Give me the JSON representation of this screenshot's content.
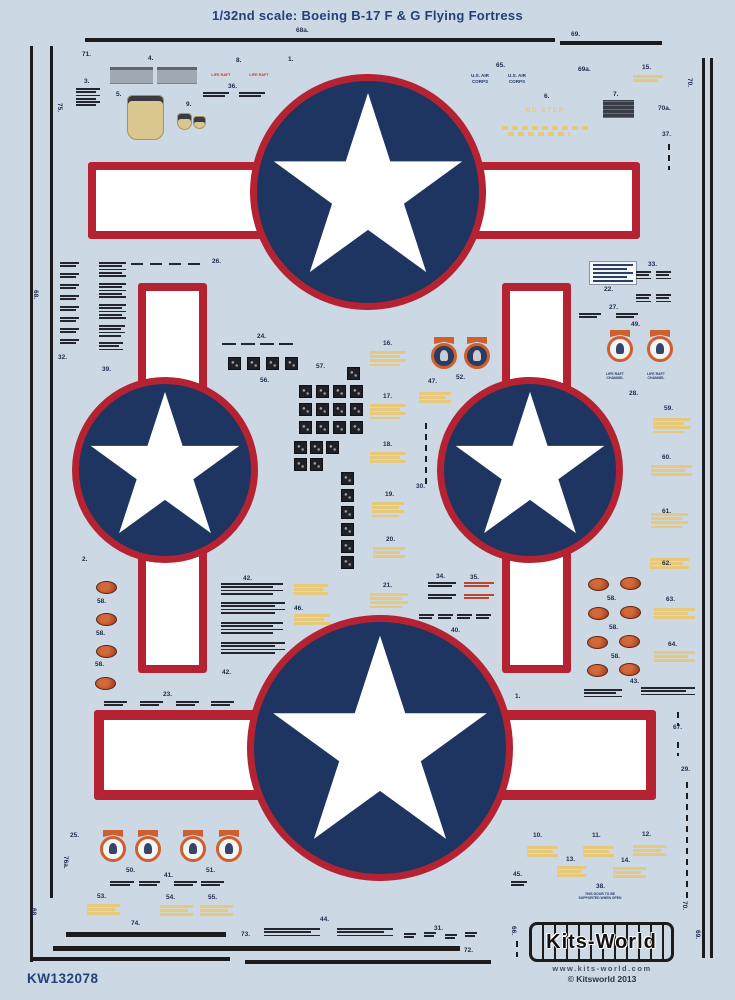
{
  "title": "1/32nd scale: Boeing B-17 F & G Flying Fortress",
  "sheet_code": "KW132078",
  "brand": {
    "logo": "Kits-World",
    "url": "www.kits-world.com",
    "copyright": "© Kitsworld 2013"
  },
  "colors": {
    "bg": "#ccd8e4",
    "navy": "#1d3560",
    "red": "#b52231",
    "star": "#ffffff",
    "yellow": "#e6c97c",
    "orange": "#cf5f2e",
    "label": "#1e2a4a",
    "dark": "#23262e",
    "gray": "#a0a8b2",
    "tan": "#d9c78f",
    "brand_navy": "#23407a",
    "stencil_red": "#c0432b"
  },
  "insignia": [
    {
      "cx": 368,
      "cy": 192,
      "r": 118,
      "star_r": 104,
      "bar": {
        "x": 88,
        "y": 162,
        "w": 552,
        "h": 77,
        "bw": 8
      }
    },
    {
      "cx": 165,
      "cy": 470,
      "r": 93,
      "star_r": 82,
      "bar": {
        "x": 138,
        "y": 283,
        "w": 69,
        "h": 390,
        "bw": 8
      }
    },
    {
      "cx": 530,
      "cy": 470,
      "r": 93,
      "star_r": 82,
      "bar": {
        "x": 502,
        "y": 283,
        "w": 69,
        "h": 390,
        "bw": 8
      }
    },
    {
      "cx": 380,
      "cy": 748,
      "r": 133,
      "star_r": 118,
      "bar": {
        "x": 94,
        "y": 710,
        "w": 562,
        "h": 90,
        "bw": 10
      }
    }
  ],
  "labels": [
    {
      "t": "71.",
      "x": 82,
      "y": 52
    },
    {
      "t": "3.",
      "x": 84,
      "y": 79
    },
    {
      "t": "4.",
      "x": 148,
      "y": 56
    },
    {
      "t": "8.",
      "x": 236,
      "y": 58
    },
    {
      "t": "36.",
      "x": 228,
      "y": 84
    },
    {
      "t": "1.",
      "x": 288,
      "y": 57
    },
    {
      "t": "5.",
      "x": 116,
      "y": 92
    },
    {
      "t": "9.",
      "x": 186,
      "y": 102
    },
    {
      "t": "65.",
      "x": 496,
      "y": 63
    },
    {
      "t": "69a.",
      "x": 578,
      "y": 67
    },
    {
      "t": "15.",
      "x": 642,
      "y": 65
    },
    {
      "t": "6.",
      "x": 544,
      "y": 94
    },
    {
      "t": "7.",
      "x": 613,
      "y": 92
    },
    {
      "t": "68a.",
      "x": 296,
      "y": 28
    },
    {
      "t": "69.",
      "x": 571,
      "y": 32
    },
    {
      "t": "70.",
      "x": 692,
      "y": 78,
      "r": 1
    },
    {
      "t": "70a.",
      "x": 658,
      "y": 106
    },
    {
      "t": "37.",
      "x": 662,
      "y": 132
    },
    {
      "t": "75.",
      "x": 62,
      "y": 103,
      "r": 1
    },
    {
      "t": "68.",
      "x": 38,
      "y": 290,
      "r": 1
    },
    {
      "t": "26.",
      "x": 212,
      "y": 259
    },
    {
      "t": "32.",
      "x": 58,
      "y": 355
    },
    {
      "t": "39.",
      "x": 102,
      "y": 367
    },
    {
      "t": "24.",
      "x": 257,
      "y": 334
    },
    {
      "t": "56.",
      "x": 260,
      "y": 378
    },
    {
      "t": "57.",
      "x": 316,
      "y": 364
    },
    {
      "t": "16.",
      "x": 383,
      "y": 341
    },
    {
      "t": "47.",
      "x": 428,
      "y": 379
    },
    {
      "t": "52.",
      "x": 456,
      "y": 375
    },
    {
      "t": "17.",
      "x": 383,
      "y": 394
    },
    {
      "t": "18.",
      "x": 383,
      "y": 442
    },
    {
      "t": "30.",
      "x": 416,
      "y": 484
    },
    {
      "t": "19.",
      "x": 385,
      "y": 492
    },
    {
      "t": "20.",
      "x": 386,
      "y": 537
    },
    {
      "t": "21.",
      "x": 383,
      "y": 583
    },
    {
      "t": "33.",
      "x": 648,
      "y": 262
    },
    {
      "t": "22.",
      "x": 604,
      "y": 287
    },
    {
      "t": "27.",
      "x": 609,
      "y": 305
    },
    {
      "t": "49.",
      "x": 631,
      "y": 322
    },
    {
      "t": "28.",
      "x": 629,
      "y": 391
    },
    {
      "t": "59.",
      "x": 664,
      "y": 406
    },
    {
      "t": "60.",
      "x": 662,
      "y": 455
    },
    {
      "t": "61.",
      "x": 662,
      "y": 509
    },
    {
      "t": "62.",
      "x": 662,
      "y": 561
    },
    {
      "t": "63.",
      "x": 666,
      "y": 597
    },
    {
      "t": "64.",
      "x": 668,
      "y": 642
    },
    {
      "t": "2.",
      "x": 82,
      "y": 557
    },
    {
      "t": "58.",
      "x": 97,
      "y": 599
    },
    {
      "t": "58.",
      "x": 96,
      "y": 631
    },
    {
      "t": "58.",
      "x": 95,
      "y": 662
    },
    {
      "t": "42.",
      "x": 243,
      "y": 576
    },
    {
      "t": "46.",
      "x": 294,
      "y": 606
    },
    {
      "t": "42.",
      "x": 222,
      "y": 670
    },
    {
      "t": "58.",
      "x": 607,
      "y": 596
    },
    {
      "t": "58.",
      "x": 609,
      "y": 625
    },
    {
      "t": "58.",
      "x": 611,
      "y": 654
    },
    {
      "t": "43.",
      "x": 630,
      "y": 679
    },
    {
      "t": "34.",
      "x": 436,
      "y": 574
    },
    {
      "t": "35.",
      "x": 470,
      "y": 575
    },
    {
      "t": "40.",
      "x": 451,
      "y": 628
    },
    {
      "t": "23.",
      "x": 163,
      "y": 692
    },
    {
      "t": "1.",
      "x": 515,
      "y": 694
    },
    {
      "t": "67.",
      "x": 673,
      "y": 725
    },
    {
      "t": "29.",
      "x": 681,
      "y": 767
    },
    {
      "t": "25.",
      "x": 70,
      "y": 833
    },
    {
      "t": "76a.",
      "x": 68,
      "y": 856,
      "r": 1
    },
    {
      "t": "68.",
      "x": 36,
      "y": 908,
      "r": 1
    },
    {
      "t": "50.",
      "x": 126,
      "y": 868
    },
    {
      "t": "41.",
      "x": 164,
      "y": 873
    },
    {
      "t": "51.",
      "x": 206,
      "y": 868
    },
    {
      "t": "53.",
      "x": 97,
      "y": 894
    },
    {
      "t": "54.",
      "x": 166,
      "y": 895
    },
    {
      "t": "55.",
      "x": 208,
      "y": 895
    },
    {
      "t": "74.",
      "x": 131,
      "y": 921
    },
    {
      "t": "73.",
      "x": 241,
      "y": 932
    },
    {
      "t": "44.",
      "x": 320,
      "y": 917
    },
    {
      "t": "31.",
      "x": 434,
      "y": 926
    },
    {
      "t": "72.",
      "x": 464,
      "y": 948
    },
    {
      "t": "10.",
      "x": 533,
      "y": 833
    },
    {
      "t": "11.",
      "x": 592,
      "y": 833
    },
    {
      "t": "12.",
      "x": 642,
      "y": 832
    },
    {
      "t": "13.",
      "x": 566,
      "y": 857
    },
    {
      "t": "14.",
      "x": 621,
      "y": 858
    },
    {
      "t": "38.",
      "x": 596,
      "y": 884
    },
    {
      "t": "45.",
      "x": 513,
      "y": 872
    },
    {
      "t": "66.",
      "x": 516,
      "y": 926,
      "r": 1
    },
    {
      "t": "70.",
      "x": 687,
      "y": 901,
      "r": 1
    },
    {
      "t": "69.",
      "x": 700,
      "y": 930,
      "r": 1
    }
  ],
  "texts": [
    {
      "lines": [
        "LIFE RAFT"
      ],
      "x": 204,
      "y": 73,
      "fs": 3.8,
      "c": "#c23b2a",
      "w": 34
    },
    {
      "lines": [
        "LIFE RAFT"
      ],
      "x": 242,
      "y": 73,
      "fs": 3.8,
      "c": "#c23b2a",
      "w": 34
    },
    {
      "lines": [
        "U.S. AIR",
        "CORPS"
      ],
      "x": 462,
      "y": 73,
      "fs": 4.6,
      "c": "#233a66",
      "w": 36
    },
    {
      "lines": [
        "U.S. AIR",
        "CORPS"
      ],
      "x": 499,
      "y": 73,
      "fs": 4.6,
      "c": "#233a66",
      "w": 36
    },
    {
      "lines": [
        "NO STEP"
      ],
      "x": 517,
      "y": 107,
      "fs": 6.5,
      "c": "#e6c97c",
      "w": 56,
      "ls": 1.5
    },
    {
      "lines": [
        "LIFE RAFT",
        "CHANNEL"
      ],
      "x": 598,
      "y": 372,
      "fs": 3.5,
      "c": "#233a66",
      "w": 34
    },
    {
      "lines": [
        "LIFE RAFT",
        "CHANNEL"
      ],
      "x": 639,
      "y": 372,
      "fs": 3.5,
      "c": "#233a66",
      "w": 34
    },
    {
      "lines": [
        "THIS DOOR TO BE",
        "SUPPORTED WHEN OPEN"
      ],
      "x": 562,
      "y": 892,
      "fs": 3.4,
      "c": "#233a66",
      "w": 76
    }
  ],
  "micro_blocks": [
    {
      "x": 76,
      "y": 88,
      "w": 24,
      "n": 6
    },
    {
      "x": 60,
      "y": 262,
      "w": 19,
      "n": 2
    },
    {
      "x": 60,
      "y": 273,
      "w": 19,
      "n": 2
    },
    {
      "x": 60,
      "y": 284,
      "w": 19,
      "n": 2
    },
    {
      "x": 60,
      "y": 295,
      "w": 19,
      "n": 2
    },
    {
      "x": 60,
      "y": 306,
      "w": 19,
      "n": 2
    },
    {
      "x": 60,
      "y": 317,
      "w": 19,
      "n": 2
    },
    {
      "x": 60,
      "y": 328,
      "w": 19,
      "n": 2
    },
    {
      "x": 60,
      "y": 339,
      "w": 19,
      "n": 2
    },
    {
      "x": 99,
      "y": 262,
      "w": 27,
      "n": 5
    },
    {
      "x": 99,
      "y": 283,
      "w": 27,
      "n": 5
    },
    {
      "x": 99,
      "y": 304,
      "w": 27,
      "n": 5
    },
    {
      "x": 99,
      "y": 325,
      "w": 26,
      "n": 4
    },
    {
      "x": 99,
      "y": 342,
      "w": 24,
      "n": 3
    },
    {
      "x": 203,
      "y": 92,
      "w": 26,
      "n": 2
    },
    {
      "x": 239,
      "y": 92,
      "w": 26,
      "n": 2
    },
    {
      "x": 636,
      "y": 271,
      "w": 15,
      "n": 3
    },
    {
      "x": 656,
      "y": 271,
      "w": 15,
      "n": 3
    },
    {
      "x": 636,
      "y": 294,
      "w": 15,
      "n": 3
    },
    {
      "x": 656,
      "y": 294,
      "w": 15,
      "n": 3
    },
    {
      "x": 579,
      "y": 313,
      "w": 22,
      "n": 2
    },
    {
      "x": 616,
      "y": 313,
      "w": 22,
      "n": 2
    },
    {
      "x": 222,
      "y": 343,
      "w": 14,
      "n": 1
    },
    {
      "x": 241,
      "y": 343,
      "w": 14,
      "n": 1
    },
    {
      "x": 260,
      "y": 343,
      "w": 14,
      "n": 1
    },
    {
      "x": 279,
      "y": 343,
      "w": 14,
      "n": 1
    },
    {
      "x": 131,
      "y": 263,
      "w": 12,
      "n": 1
    },
    {
      "x": 150,
      "y": 263,
      "w": 12,
      "n": 1
    },
    {
      "x": 169,
      "y": 263,
      "w": 12,
      "n": 1
    },
    {
      "x": 188,
      "y": 263,
      "w": 12,
      "n": 1
    },
    {
      "x": 428,
      "y": 582,
      "w": 28,
      "n": 2
    },
    {
      "x": 428,
      "y": 594,
      "w": 28,
      "n": 2
    },
    {
      "x": 464,
      "y": 582,
      "w": 30,
      "n": 2,
      "c": "r"
    },
    {
      "x": 464,
      "y": 594,
      "w": 30,
      "n": 2,
      "c": "r"
    },
    {
      "x": 419,
      "y": 614,
      "w": 15,
      "n": 2
    },
    {
      "x": 438,
      "y": 614,
      "w": 15,
      "n": 2
    },
    {
      "x": 457,
      "y": 614,
      "w": 15,
      "n": 2
    },
    {
      "x": 476,
      "y": 614,
      "w": 15,
      "n": 2
    },
    {
      "x": 221,
      "y": 583,
      "w": 62,
      "n": 4
    },
    {
      "x": 221,
      "y": 602,
      "w": 64,
      "n": 4
    },
    {
      "x": 221,
      "y": 622,
      "w": 62,
      "n": 4
    },
    {
      "x": 221,
      "y": 642,
      "w": 64,
      "n": 4
    },
    {
      "x": 584,
      "y": 689,
      "w": 38,
      "n": 3
    },
    {
      "x": 641,
      "y": 687,
      "w": 54,
      "n": 3
    },
    {
      "x": 104,
      "y": 701,
      "w": 23,
      "n": 2
    },
    {
      "x": 140,
      "y": 701,
      "w": 23,
      "n": 2
    },
    {
      "x": 176,
      "y": 701,
      "w": 23,
      "n": 2
    },
    {
      "x": 211,
      "y": 701,
      "w": 23,
      "n": 2
    },
    {
      "x": 404,
      "y": 933,
      "w": 12,
      "n": 2
    },
    {
      "x": 424,
      "y": 932,
      "w": 12,
      "n": 2
    },
    {
      "x": 445,
      "y": 934,
      "w": 12,
      "n": 2
    },
    {
      "x": 465,
      "y": 932,
      "w": 12,
      "n": 2
    },
    {
      "x": 264,
      "y": 928,
      "w": 56,
      "n": 3
    },
    {
      "x": 337,
      "y": 928,
      "w": 56,
      "n": 3
    },
    {
      "x": 511,
      "y": 881,
      "w": 16,
      "n": 2
    },
    {
      "x": 110,
      "y": 881,
      "w": 24,
      "n": 2
    },
    {
      "x": 139,
      "y": 881,
      "w": 21,
      "n": 2
    },
    {
      "x": 174,
      "y": 881,
      "w": 23,
      "n": 2
    },
    {
      "x": 201,
      "y": 881,
      "w": 23,
      "n": 2
    },
    {
      "x": 633,
      "y": 75,
      "w": 30,
      "n": 2,
      "c": "y"
    },
    {
      "x": 370,
      "y": 351,
      "w": 36,
      "n": 4,
      "c": "y"
    },
    {
      "x": 370,
      "y": 404,
      "w": 36,
      "n": 4,
      "c": "y"
    },
    {
      "x": 370,
      "y": 452,
      "w": 36,
      "n": 3,
      "c": "y"
    },
    {
      "x": 372,
      "y": 502,
      "w": 32,
      "n": 4,
      "c": "y"
    },
    {
      "x": 373,
      "y": 547,
      "w": 32,
      "n": 3,
      "c": "y"
    },
    {
      "x": 370,
      "y": 593,
      "w": 38,
      "n": 4,
      "c": "y"
    },
    {
      "x": 419,
      "y": 392,
      "w": 32,
      "n": 3,
      "c": "y"
    },
    {
      "x": 294,
      "y": 584,
      "w": 34,
      "n": 3,
      "c": "y"
    },
    {
      "x": 294,
      "y": 614,
      "w": 36,
      "n": 3,
      "c": "y"
    },
    {
      "x": 653,
      "y": 418,
      "w": 37,
      "n": 4,
      "c": "y"
    },
    {
      "x": 651,
      "y": 465,
      "w": 41,
      "n": 3,
      "c": "y"
    },
    {
      "x": 651,
      "y": 513,
      "w": 37,
      "n": 4,
      "c": "y"
    },
    {
      "x": 650,
      "y": 558,
      "w": 39,
      "n": 3,
      "c": "y"
    },
    {
      "x": 654,
      "y": 608,
      "w": 41,
      "n": 3,
      "c": "y"
    },
    {
      "x": 654,
      "y": 651,
      "w": 41,
      "n": 3,
      "c": "y"
    },
    {
      "x": 87,
      "y": 904,
      "w": 33,
      "n": 3,
      "c": "y"
    },
    {
      "x": 160,
      "y": 905,
      "w": 33,
      "n": 3,
      "c": "y"
    },
    {
      "x": 200,
      "y": 905,
      "w": 33,
      "n": 3,
      "c": "y"
    },
    {
      "x": 527,
      "y": 846,
      "w": 31,
      "n": 3,
      "c": "y"
    },
    {
      "x": 583,
      "y": 846,
      "w": 31,
      "n": 3,
      "c": "y"
    },
    {
      "x": 633,
      "y": 845,
      "w": 33,
      "n": 3,
      "c": "y"
    },
    {
      "x": 557,
      "y": 866,
      "w": 29,
      "n": 3,
      "c": "y"
    },
    {
      "x": 613,
      "y": 867,
      "w": 33,
      "n": 3,
      "c": "y"
    }
  ],
  "black_squares": [
    [
      228,
      357
    ],
    [
      247,
      357
    ],
    [
      266,
      357
    ],
    [
      285,
      357
    ],
    [
      347,
      367
    ],
    [
      299,
      385
    ],
    [
      316,
      385
    ],
    [
      333,
      385
    ],
    [
      350,
      385
    ],
    [
      299,
      403
    ],
    [
      316,
      403
    ],
    [
      333,
      403
    ],
    [
      350,
      403
    ],
    [
      299,
      421
    ],
    [
      316,
      421
    ],
    [
      333,
      421
    ],
    [
      350,
      421
    ],
    [
      294,
      441
    ],
    [
      310,
      441
    ],
    [
      326,
      441
    ],
    [
      294,
      458
    ],
    [
      310,
      458
    ],
    [
      341,
      472
    ],
    [
      341,
      489
    ],
    [
      341,
      506
    ],
    [
      341,
      523
    ],
    [
      341,
      540
    ],
    [
      341,
      556
    ]
  ],
  "ovals": [
    [
      96,
      581
    ],
    [
      96,
      613
    ],
    [
      96,
      645
    ],
    [
      95,
      677
    ],
    [
      588,
      578
    ],
    [
      620,
      577
    ],
    [
      588,
      607
    ],
    [
      620,
      606
    ],
    [
      587,
      636
    ],
    [
      619,
      635
    ],
    [
      587,
      664
    ],
    [
      619,
      663
    ]
  ],
  "emblems": [
    {
      "x": 430,
      "y": 337,
      "dark": 1
    },
    {
      "x": 463,
      "y": 337,
      "dark": 1
    },
    {
      "x": 606,
      "y": 330
    },
    {
      "x": 646,
      "y": 330
    },
    {
      "x": 99,
      "y": 830
    },
    {
      "x": 134,
      "y": 830
    },
    {
      "x": 179,
      "y": 830
    },
    {
      "x": 215,
      "y": 830
    }
  ],
  "rects": [
    {
      "k": "gray",
      "x": 110,
      "y": 67,
      "w": 43,
      "h": 17
    },
    {
      "k": "gray",
      "x": 157,
      "y": 67,
      "w": 40,
      "h": 17
    },
    {
      "k": "tan",
      "x": 127,
      "y": 95,
      "w": 37,
      "h": 45
    },
    {
      "k": "tan",
      "x": 177,
      "y": 113,
      "w": 15,
      "h": 17
    },
    {
      "k": "tan",
      "x": 193,
      "y": 116,
      "w": 13,
      "h": 13
    },
    {
      "k": "dark",
      "x": 603,
      "y": 100,
      "w": 31,
      "h": 18
    },
    {
      "k": "white",
      "x": 589,
      "y": 261,
      "w": 48,
      "h": 24
    }
  ],
  "lines": [
    {
      "x": 85,
      "y": 38,
      "w": 470,
      "h": 3.5
    },
    {
      "x": 560,
      "y": 41,
      "w": 102,
      "h": 3.5
    },
    {
      "x": 30,
      "y": 46,
      "w": 3,
      "h": 916
    },
    {
      "x": 50,
      "y": 46,
      "w": 3,
      "h": 852
    },
    {
      "x": 702,
      "y": 58,
      "w": 3,
      "h": 900
    },
    {
      "x": 710,
      "y": 58,
      "w": 3,
      "h": 900
    },
    {
      "x": 66,
      "y": 932,
      "w": 160,
      "h": 5
    },
    {
      "x": 53,
      "y": 946,
      "w": 407,
      "h": 5
    },
    {
      "x": 33,
      "y": 957,
      "w": 197,
      "h": 4
    },
    {
      "x": 245,
      "y": 960,
      "w": 246,
      "h": 4
    }
  ],
  "dashed": [
    {
      "x": 425,
      "y": 423,
      "len": 64
    },
    {
      "x": 686,
      "y": 782,
      "len": 118
    },
    {
      "x": 677,
      "y": 712,
      "len": 14
    },
    {
      "x": 677,
      "y": 742,
      "len": 14
    },
    {
      "x": 668,
      "y": 144,
      "len": 26
    },
    {
      "x": 516,
      "y": 941,
      "len": 16
    },
    {
      "x": 502,
      "y": 126,
      "len": 88,
      "horiz": 1,
      "c": "y"
    },
    {
      "x": 508,
      "y": 132,
      "len": 62,
      "horiz": 1,
      "c": "y"
    }
  ],
  "star_points": "0,-100 22.5,-30.9 95.1,-30.9 36.3,11.8 58.8,80.9 0,38.2 -58.8,80.9 -36.3,11.8 -95.1,-30.9 -22.5,-30.9"
}
